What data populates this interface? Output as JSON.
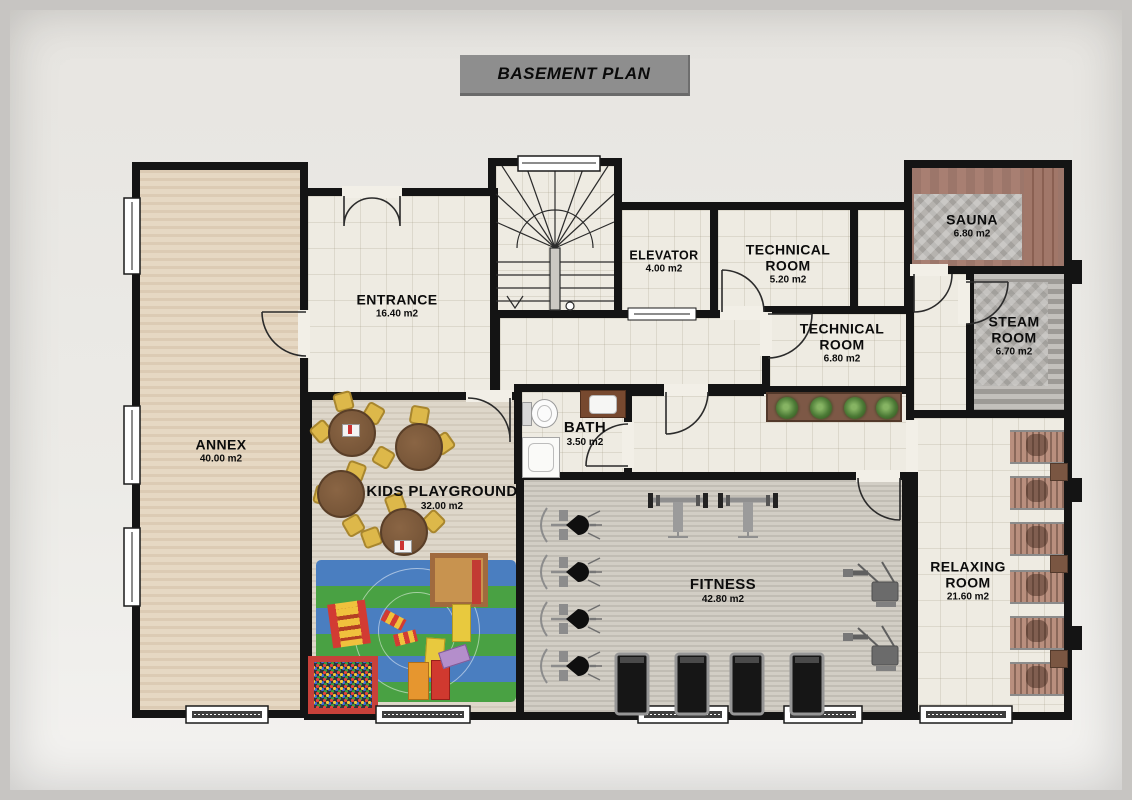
{
  "title": "BASEMENT PLAN",
  "rooms": {
    "annex": {
      "name": "ANNEX",
      "area": "40.00 m2"
    },
    "entrance": {
      "name": "ENTRANCE",
      "area": "16.40 m2"
    },
    "elevator": {
      "name": "ELEVATOR",
      "area": "4.00 m2"
    },
    "technical_room_1": {
      "name": "TECHNICAL ROOM",
      "area": "5.20 m2"
    },
    "technical_room_2": {
      "name": "TECHNICAL ROOM",
      "area": "6.80 m2"
    },
    "sauna": {
      "name": "SAUNA",
      "area": "6.80 m2"
    },
    "steam_room": {
      "name": "STEAM ROOM",
      "area": "6.70 m2"
    },
    "bath": {
      "name": "BATH",
      "area": "3.50 m2"
    },
    "kids_playground": {
      "name": "KIDS PLAYGROUND",
      "area": "32.00 m2"
    },
    "fitness": {
      "name": "FITNESS",
      "area": "42.80 m2"
    },
    "relaxing_room": {
      "name": "RELAXING ROOM",
      "area": "21.60 m2"
    }
  },
  "colors": {
    "wall": "#141414",
    "title_bg": "#8e8e8e",
    "tile": "#eeebe2",
    "annex_wood": "#e6d8c3",
    "kids_wood": "#ded7ca",
    "fitness_wood": "#d2cec5",
    "sauna_wood": "#a87f72",
    "stone": "#b6b3af",
    "mat_blue": "#4a7ec0",
    "mat_green": "#49a143",
    "accent_red": "#c8413a",
    "chair_yellow": "#ddb84a",
    "planter_brown": "#7d5846",
    "plant_green": "#4c7a36"
  }
}
